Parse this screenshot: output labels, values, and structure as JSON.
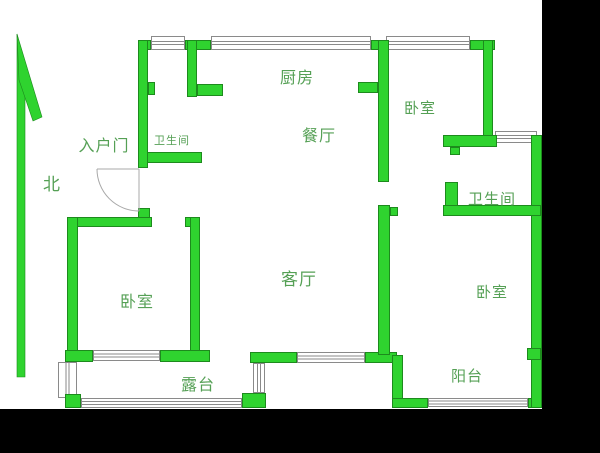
{
  "canvas": {
    "width": 600,
    "height": 453,
    "background": "#000000"
  },
  "paper": {
    "x": 0,
    "y": 0,
    "w": 542,
    "h": 409,
    "color": "#ffffff"
  },
  "colors": {
    "wall_fill": "#2fd32f",
    "wall_stroke": "#1d8a1d",
    "label_text": "#55a055",
    "window_border": "#8a8a8a",
    "window_fill": "#ffffff",
    "door_line": "#a8a8a8"
  },
  "north_arrow": {
    "label": "北",
    "label_x": 52,
    "label_y": 190,
    "label_size": 17,
    "shaft": [
      [
        17,
        34
      ],
      [
        25,
        66
      ],
      [
        25,
        377
      ],
      [
        17,
        377
      ]
    ],
    "barb": [
      [
        17,
        34
      ],
      [
        42,
        117
      ],
      [
        33,
        121
      ],
      [
        19,
        80
      ]
    ]
  },
  "rooms": [
    {
      "id": "kitchen",
      "text": "厨房",
      "x": 297,
      "y": 83,
      "size": 16
    },
    {
      "id": "dining-room",
      "text": "餐厅",
      "x": 319,
      "y": 141,
      "size": 16
    },
    {
      "id": "bedroom-top-right",
      "text": "卧室",
      "x": 420,
      "y": 113,
      "size": 15
    },
    {
      "id": "bathroom-right",
      "text": "卫生间",
      "x": 492,
      "y": 204,
      "size": 15
    },
    {
      "id": "bathroom-left",
      "text": "卫生间",
      "x": 172,
      "y": 144,
      "size": 11
    },
    {
      "id": "entry-door",
      "text": "入户门",
      "x": 104,
      "y": 151,
      "size": 16
    },
    {
      "id": "living-room",
      "text": "客厅",
      "x": 299,
      "y": 285,
      "size": 17
    },
    {
      "id": "bedroom-bottom-left",
      "text": "卧室",
      "x": 137,
      "y": 307,
      "size": 16
    },
    {
      "id": "bedroom-bottom-right",
      "text": "卧室",
      "x": 492,
      "y": 297,
      "size": 15
    },
    {
      "id": "terrace",
      "text": "露台",
      "x": 198,
      "y": 390,
      "size": 16
    },
    {
      "id": "balcony",
      "text": "阳台",
      "x": 467,
      "y": 381,
      "size": 15
    }
  ],
  "walls": [
    {
      "x": 138,
      "y": 40,
      "w": 13,
      "h": 10
    },
    {
      "x": 138,
      "y": 40,
      "w": 10,
      "h": 128
    },
    {
      "x": 148,
      "y": 82,
      "w": 7,
      "h": 13
    },
    {
      "x": 185,
      "y": 40,
      "w": 26,
      "h": 10
    },
    {
      "x": 371,
      "y": 40,
      "w": 16,
      "h": 10
    },
    {
      "x": 470,
      "y": 40,
      "w": 25,
      "h": 10
    },
    {
      "x": 483,
      "y": 40,
      "w": 10,
      "h": 103
    },
    {
      "x": 187,
      "y": 40,
      "w": 10,
      "h": 57
    },
    {
      "x": 197,
      "y": 84,
      "w": 26,
      "h": 12
    },
    {
      "x": 147,
      "y": 152,
      "w": 55,
      "h": 11
    },
    {
      "x": 138,
      "y": 208,
      "w": 12,
      "h": 10
    },
    {
      "x": 67,
      "y": 217,
      "w": 85,
      "h": 10
    },
    {
      "x": 185,
      "y": 217,
      "w": 15,
      "h": 10
    },
    {
      "x": 190,
      "y": 217,
      "w": 10,
      "h": 145
    },
    {
      "x": 67,
      "y": 217,
      "w": 11,
      "h": 140
    },
    {
      "x": 65,
      "y": 350,
      "w": 28,
      "h": 12
    },
    {
      "x": 160,
      "y": 350,
      "w": 50,
      "h": 12
    },
    {
      "x": 65,
      "y": 394,
      "w": 16,
      "h": 14
    },
    {
      "x": 242,
      "y": 393,
      "w": 24,
      "h": 15
    },
    {
      "x": 250,
      "y": 352,
      "w": 47,
      "h": 11
    },
    {
      "x": 365,
      "y": 352,
      "w": 32,
      "h": 11
    },
    {
      "x": 378,
      "y": 40,
      "w": 11,
      "h": 142
    },
    {
      "x": 358,
      "y": 82,
      "w": 20,
      "h": 11
    },
    {
      "x": 378,
      "y": 205,
      "w": 12,
      "h": 150
    },
    {
      "x": 390,
      "y": 207,
      "w": 8,
      "h": 9
    },
    {
      "x": 392,
      "y": 355,
      "w": 11,
      "h": 48
    },
    {
      "x": 392,
      "y": 398,
      "w": 36,
      "h": 10
    },
    {
      "x": 528,
      "y": 398,
      "w": 14,
      "h": 10
    },
    {
      "x": 531,
      "y": 135,
      "w": 11,
      "h": 273
    },
    {
      "x": 527,
      "y": 348,
      "w": 14,
      "h": 12
    },
    {
      "x": 443,
      "y": 135,
      "w": 54,
      "h": 12
    },
    {
      "x": 450,
      "y": 147,
      "w": 10,
      "h": 8
    },
    {
      "x": 445,
      "y": 182,
      "w": 13,
      "h": 33
    },
    {
      "x": 443,
      "y": 205,
      "w": 98,
      "h": 11
    }
  ],
  "windows": [
    {
      "x": 151,
      "y": 36,
      "w": 34,
      "h": 14,
      "orient": "h"
    },
    {
      "x": 211,
      "y": 36,
      "w": 160,
      "h": 14,
      "orient": "h"
    },
    {
      "x": 386,
      "y": 36,
      "w": 84,
      "h": 14,
      "orient": "h"
    },
    {
      "x": 495,
      "y": 131,
      "w": 42,
      "h": 12,
      "orient": "h"
    },
    {
      "x": 93,
      "y": 350,
      "w": 67,
      "h": 11,
      "orient": "h"
    },
    {
      "x": 58,
      "y": 362,
      "w": 19,
      "h": 36,
      "orient": "v"
    },
    {
      "x": 81,
      "y": 398,
      "w": 161,
      "h": 10,
      "orient": "h"
    },
    {
      "x": 253,
      "y": 363,
      "w": 12,
      "h": 30,
      "orient": "v"
    },
    {
      "x": 297,
      "y": 352,
      "w": 68,
      "h": 11,
      "orient": "h"
    },
    {
      "x": 428,
      "y": 398,
      "w": 100,
      "h": 9,
      "orient": "h"
    }
  ],
  "entry_door_swing": {
    "lines": [
      [
        97,
        169,
        139,
        169
      ],
      [
        139,
        169,
        139,
        211
      ]
    ],
    "arc_path": "M 97 169 A 42 42 0 0 0 139 211"
  }
}
